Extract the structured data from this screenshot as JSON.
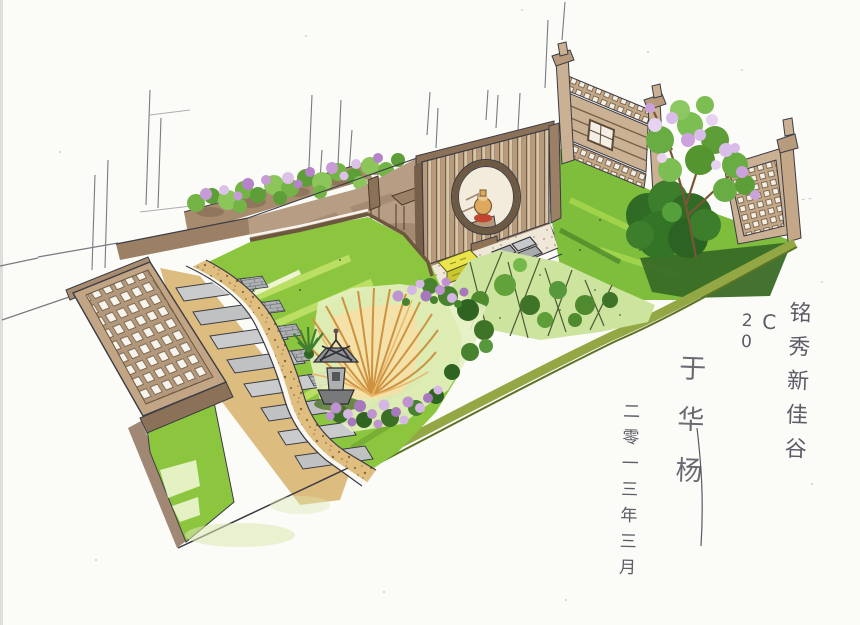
{
  "artwork": {
    "kind": "hand-drawn marker-and-ink landscape design rendering",
    "scene": "courtyard garden perspective with moon-gate screen, trellis deck, steps and planting beds"
  },
  "inscription": {
    "project_title": "铭秀新佳谷",
    "plan_code": "C",
    "plan_number": "20",
    "signature": "于华杨",
    "date": "二零一三年三月"
  },
  "scene_elements": [
    "background-sketch-lines",
    "border-planter-flowers",
    "terrace-wall",
    "patio-terrace",
    "table-and-chairs",
    "moon-gate-screen",
    "display-vase",
    "screen-base",
    "gravel-court",
    "stepping-stones",
    "seat-cushion",
    "back-lawn",
    "fence-panel-left",
    "fence-panel-right",
    "blossom-tree",
    "big-shrub",
    "bamboo-bed",
    "edge-band",
    "main-lawn",
    "gravel-path",
    "paver-steps",
    "side-lawn-strip",
    "wood-trellis-deck",
    "golden-grass",
    "stone-lantern",
    "purple-flowers",
    "spiky-plant",
    "inscription"
  ],
  "palette": {
    "paper": "#FBFBF8",
    "ink": "#3C3C44",
    "lawn_green": "#8CC63E",
    "lawn_highlight": "#C3E26B",
    "foliage_dark": "#2F6B25",
    "blossom_purple": "#C79BD6",
    "wood_tan": "#C2A585",
    "wood_dark": "#8A7158",
    "gravel_tan": "#DFBE80",
    "paver_gray": "#C9CBCD",
    "grass_gold": "#CE9240",
    "cushion_yellow": "#E9E44C",
    "vase_red": "#C1452E",
    "edge_olive": "#93A845"
  }
}
